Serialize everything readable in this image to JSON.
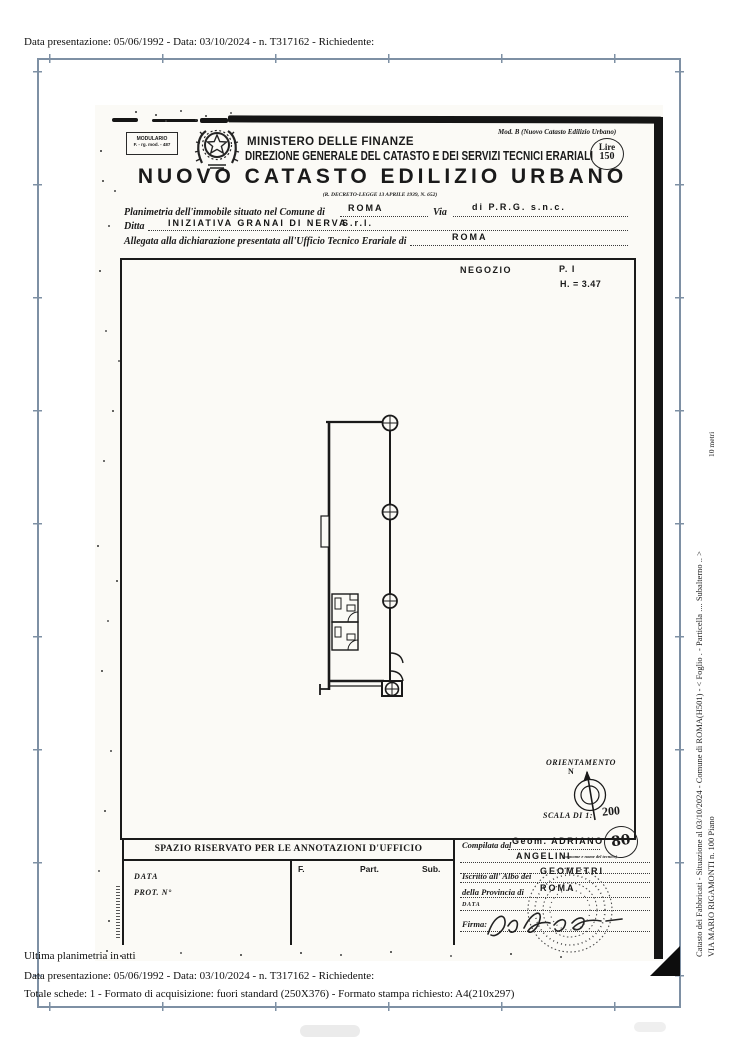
{
  "colors": {
    "ink": "#1a1a1a",
    "frame_line": "#7e90a4",
    "scan_background": "#fbfaf6"
  },
  "page_margins": {
    "top_line": "Data presentazione: 05/06/1992 - Data: 03/10/2024 - n. T317162 - Richiedente:",
    "bottom_note": "Ultima planimetria in atti",
    "bottom_line1": "Data presentazione: 05/06/1992 - Data: 03/10/2024 - n. T317162 - Richiedente:",
    "bottom_line2": "Totale schede: 1 - Formato di acquisizione: fuori standard (250X376) - Formato stampa richiesto: A4(210x297)",
    "side_line1": "Catasto dei Fabbricati - Situazione al 03/10/2024 - Comune di ROMA(H501) - <  Foglio .  - Particella ....   Subalterno .. >",
    "side_line2": "VIA MARIO RIGAMONTI n. 100 Piano",
    "side_scale": "10 metri"
  },
  "header": {
    "modulario_line1": "MODULARIO",
    "modulario_line2": "F. - rg. mod. - 487",
    "ministry": "MINISTERO DELLE FINANZE",
    "direction": "DIREZIONE GENERALE DEL CATASTO E DEI SERVIZI TECNICI ERARIALI",
    "mod_b": "Mod. B (Nuovo Catasto Edilizio Urbano)",
    "stamp_value_label": "Lire",
    "stamp_value": "150",
    "title": "NUOVO CATASTO EDILIZIO URBANO",
    "decree": "(R. DECRETO-LEGGE 13 APRILE 1939, N. 652)"
  },
  "form": {
    "comune_label": "Planimetria dell'immobile situato nel Comune di",
    "comune_value": "ROMA",
    "via_label": "Via",
    "via_value": "di P.R.G.  s.n.c.",
    "ditta_label": "Ditta",
    "ditta_value": "INIZIATIVA GRANAI DI NERVA",
    "ditta_value_suffix": "S.r.l.",
    "ufficio_label": "Allegata alla dichiarazione presentata all'Ufficio Tecnico Erariale di",
    "ufficio_value": "ROMA"
  },
  "plan": {
    "room_label": "NEGOZIO",
    "floor_label": "P. I",
    "height_label": "H. = 3.47",
    "orientation_label": "ORIENTAMENTO",
    "north_label": "N",
    "scale_label": "SCALA DI 1:",
    "scale_value": "200"
  },
  "annotations": {
    "header": "SPAZIO RISERVATO PER LE ANNOTAZIONI D'UFFICIO",
    "data_label": "DATA",
    "prot_label": "PROT. N°",
    "col_foglio": "F.",
    "col_part": "Part.",
    "col_sub": "Sub."
  },
  "compiler": {
    "compiled_by_label": "Compilata dal",
    "technician_line1": "Geom.  ADRIANO",
    "technician_line2": "ANGELINI",
    "technician_note": "(cognome e nome del tecnico)",
    "register_label": "Iscritto all' Albo dei",
    "register_value": "GEOMETRI",
    "province_label": "della Provincia di",
    "province_value": "ROMA",
    "date_label": "DATA",
    "signature_label": "Firma:",
    "badge_number": "80"
  }
}
